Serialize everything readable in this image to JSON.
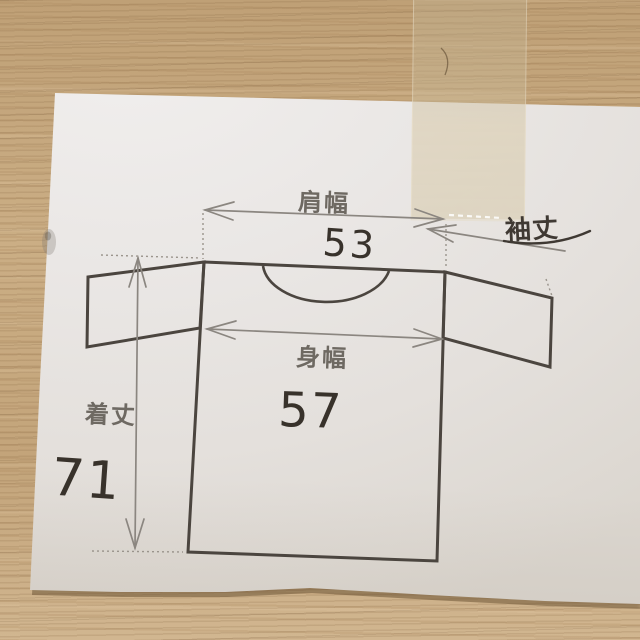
{
  "measurements": {
    "shoulder_width": {
      "label": "肩幅",
      "value": "53"
    },
    "sleeve_length": {
      "label": "袖丈"
    },
    "body_width": {
      "label": "身幅",
      "value": "57"
    },
    "garment_length": {
      "label": "着丈",
      "value": "71"
    }
  },
  "colors": {
    "wood_base": "#c7a87e",
    "paper": "#eae7e5",
    "tape": "#d6c5a4",
    "outline_ink": "#4b453f",
    "measure_line_gray": "#8b8680",
    "printed_label_gray": "#6e6962",
    "pen_ink": "#38322b"
  }
}
